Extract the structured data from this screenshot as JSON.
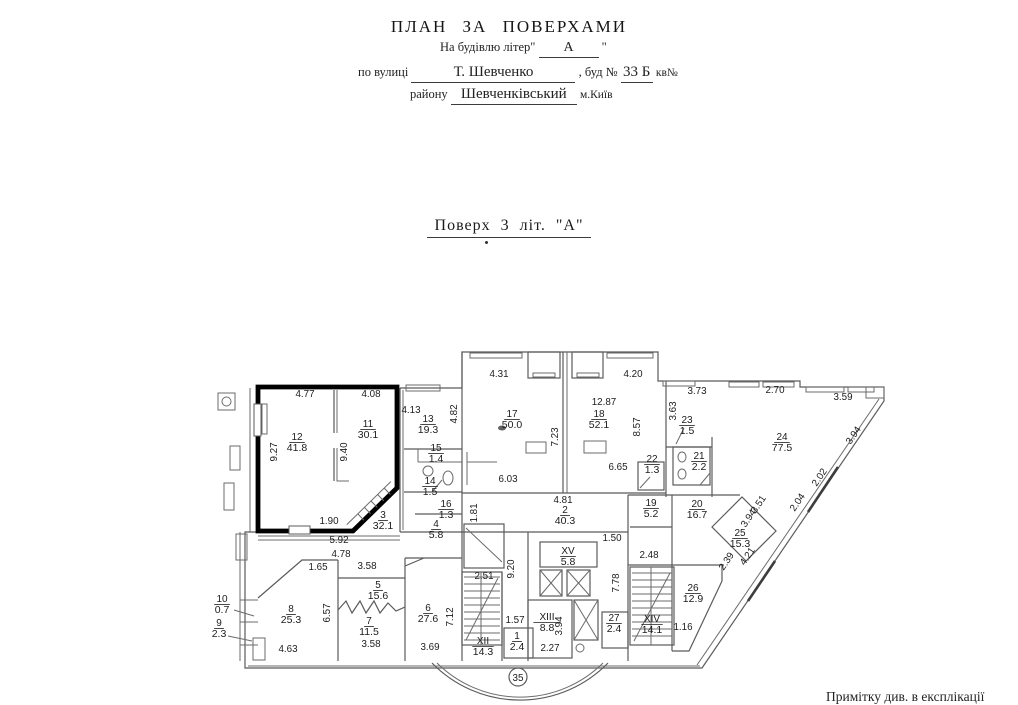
{
  "header": {
    "title": "ПЛАН  ЗА  ПОВЕРХАМИ",
    "building_line": {
      "prefix": "На будівлю літер\"",
      "value": "А",
      "suffix": "\""
    },
    "street_line": {
      "prefix": "по вулиці",
      "street": "Т. Шевченко",
      "middle": ", буд №",
      "number": "33 Б",
      "suffix": "кв№"
    },
    "district_line": {
      "prefix": "району",
      "district": "Шевченківський",
      "suffix": "м.Київ"
    }
  },
  "floor_title": "Поверх  3  літ. \"А\"",
  "note": "Примітку див. в експлікації",
  "plan": {
    "highlight_color": "#000000",
    "entrance_label": "35",
    "rooms": [
      {
        "n": "12",
        "a": "41.8",
        "x": 297,
        "y": 440
      },
      {
        "n": "11",
        "a": "30.1",
        "x": 368,
        "y": 427
      },
      {
        "n": "3",
        "a": "32.1",
        "x": 383,
        "y": 518
      },
      {
        "n": "13",
        "a": "19.3",
        "x": 428,
        "y": 422
      },
      {
        "n": "15",
        "a": "1.4",
        "x": 436,
        "y": 451
      },
      {
        "n": "14",
        "a": "1.5",
        "x": 430,
        "y": 484
      },
      {
        "n": "16",
        "a": "1.3",
        "x": 446,
        "y": 507
      },
      {
        "n": "4",
        "a": "5.8",
        "x": 436,
        "y": 527
      },
      {
        "n": "17",
        "a": "50.0",
        "x": 512,
        "y": 417
      },
      {
        "n": "18",
        "a": "52.1",
        "x": 599,
        "y": 417
      },
      {
        "n": "22",
        "a": "1.3",
        "x": 652,
        "y": 462
      },
      {
        "n": "23",
        "a": "1.5",
        "x": 687,
        "y": 423
      },
      {
        "n": "21",
        "a": "2.2",
        "x": 699,
        "y": 459
      },
      {
        "n": "24",
        "a": "77.5",
        "x": 782,
        "y": 440
      },
      {
        "n": "19",
        "a": "5.2",
        "x": 651,
        "y": 506
      },
      {
        "n": "20",
        "a": "16.7",
        "x": 697,
        "y": 507
      },
      {
        "n": "25",
        "a": "15.3",
        "x": 740,
        "y": 536
      },
      {
        "n": "26",
        "a": "12.9",
        "x": 693,
        "y": 591
      },
      {
        "n": "2",
        "a": "40.3",
        "x": 565,
        "y": 513
      },
      {
        "n": "XV",
        "a": "5.8",
        "x": 568,
        "y": 554
      },
      {
        "n": "XIII",
        "a": "8.8",
        "x": 547,
        "y": 620
      },
      {
        "n": "XII",
        "a": "14.3",
        "x": 483,
        "y": 644
      },
      {
        "n": "1",
        "a": "2.4",
        "x": 517,
        "y": 639
      },
      {
        "n": "27",
        "a": "2.4",
        "x": 614,
        "y": 621
      },
      {
        "n": "XIV",
        "a": "14.1",
        "x": 652,
        "y": 622
      },
      {
        "n": "5",
        "a": "15.6",
        "x": 378,
        "y": 588
      },
      {
        "n": "7",
        "a": "11.5",
        "x": 369,
        "y": 624
      },
      {
        "n": "8",
        "a": "25.3",
        "x": 291,
        "y": 612
      },
      {
        "n": "6",
        "a": "27.6",
        "x": 428,
        "y": 611
      },
      {
        "n": "10",
        "a": "0.7",
        "x": 222,
        "y": 602
      },
      {
        "n": "9",
        "a": "2.3",
        "x": 219,
        "y": 626
      }
    ],
    "dims": [
      {
        "t": "4.77",
        "x": 305,
        "y": 397,
        "r": 0
      },
      {
        "t": "4.08",
        "x": 371,
        "y": 397,
        "r": 0
      },
      {
        "t": "9.27",
        "x": 277,
        "y": 452,
        "r": -90
      },
      {
        "t": "9.40",
        "x": 347,
        "y": 452,
        "r": -90
      },
      {
        "t": "1.90",
        "x": 329,
        "y": 524,
        "r": 0
      },
      {
        "t": "5.92",
        "x": 339,
        "y": 543,
        "r": 0
      },
      {
        "t": "4.78",
        "x": 341,
        "y": 557,
        "r": 0
      },
      {
        "t": "4.13",
        "x": 411,
        "y": 413,
        "r": 0
      },
      {
        "t": "4.82",
        "x": 457,
        "y": 414,
        "r": -90
      },
      {
        "t": "4.31",
        "x": 499,
        "y": 377,
        "r": 0
      },
      {
        "t": "4.20",
        "x": 633,
        "y": 377,
        "r": 0
      },
      {
        "t": "12.87",
        "x": 604,
        "y": 405,
        "r": 0
      },
      {
        "t": "7.23",
        "x": 558,
        "y": 437,
        "r": -90
      },
      {
        "t": "8.57",
        "x": 640,
        "y": 427,
        "r": -90
      },
      {
        "t": "6.65",
        "x": 618,
        "y": 470,
        "r": 0
      },
      {
        "t": "6.03",
        "x": 508,
        "y": 482,
        "r": 0
      },
      {
        "t": "3.73",
        "x": 697,
        "y": 394,
        "r": 0
      },
      {
        "t": "2.70",
        "x": 775,
        "y": 393,
        "r": 0
      },
      {
        "t": "3.59",
        "x": 843,
        "y": 400,
        "r": 0
      },
      {
        "t": "3.63",
        "x": 676,
        "y": 411,
        "r": -90
      },
      {
        "t": "3.94",
        "x": 856,
        "y": 437,
        "r": -56
      },
      {
        "t": "2.02",
        "x": 822,
        "y": 479,
        "r": -56
      },
      {
        "t": "2.04",
        "x": 800,
        "y": 504,
        "r": -56
      },
      {
        "t": "3.51",
        "x": 761,
        "y": 506,
        "r": -56
      },
      {
        "t": "3.94",
        "x": 751,
        "y": 520,
        "r": -56
      },
      {
        "t": "4.21",
        "x": 750,
        "y": 558,
        "r": -56
      },
      {
        "t": "2.39",
        "x": 729,
        "y": 563,
        "r": -56
      },
      {
        "t": "1.81",
        "x": 477,
        "y": 513,
        "r": -90
      },
      {
        "t": "9.20",
        "x": 514,
        "y": 569,
        "r": -90
      },
      {
        "t": "4.81",
        "x": 563,
        "y": 503,
        "r": 0
      },
      {
        "t": "1.50",
        "x": 612,
        "y": 541,
        "r": 0
      },
      {
        "t": "7.78",
        "x": 619,
        "y": 583,
        "r": -90
      },
      {
        "t": "2.48",
        "x": 649,
        "y": 558,
        "r": 0
      },
      {
        "t": "2.51",
        "x": 484,
        "y": 579,
        "r": 0
      },
      {
        "t": "7.12",
        "x": 453,
        "y": 617,
        "r": -90
      },
      {
        "t": "1.57",
        "x": 515,
        "y": 623,
        "r": 0
      },
      {
        "t": "3.94",
        "x": 562,
        "y": 626,
        "r": -90
      },
      {
        "t": "2.27",
        "x": 550,
        "y": 651,
        "r": 0
      },
      {
        "t": "1.16",
        "x": 683,
        "y": 630,
        "r": 0
      },
      {
        "t": "1.65",
        "x": 318,
        "y": 570,
        "r": 0
      },
      {
        "t": "3.58",
        "x": 367,
        "y": 569,
        "r": 0
      },
      {
        "t": "6.57",
        "x": 330,
        "y": 613,
        "r": -90
      },
      {
        "t": "4.63",
        "x": 288,
        "y": 652,
        "r": 0
      },
      {
        "t": "3.58",
        "x": 371,
        "y": 647,
        "r": 0
      },
      {
        "t": "3.69",
        "x": 430,
        "y": 650,
        "r": 0
      }
    ]
  }
}
